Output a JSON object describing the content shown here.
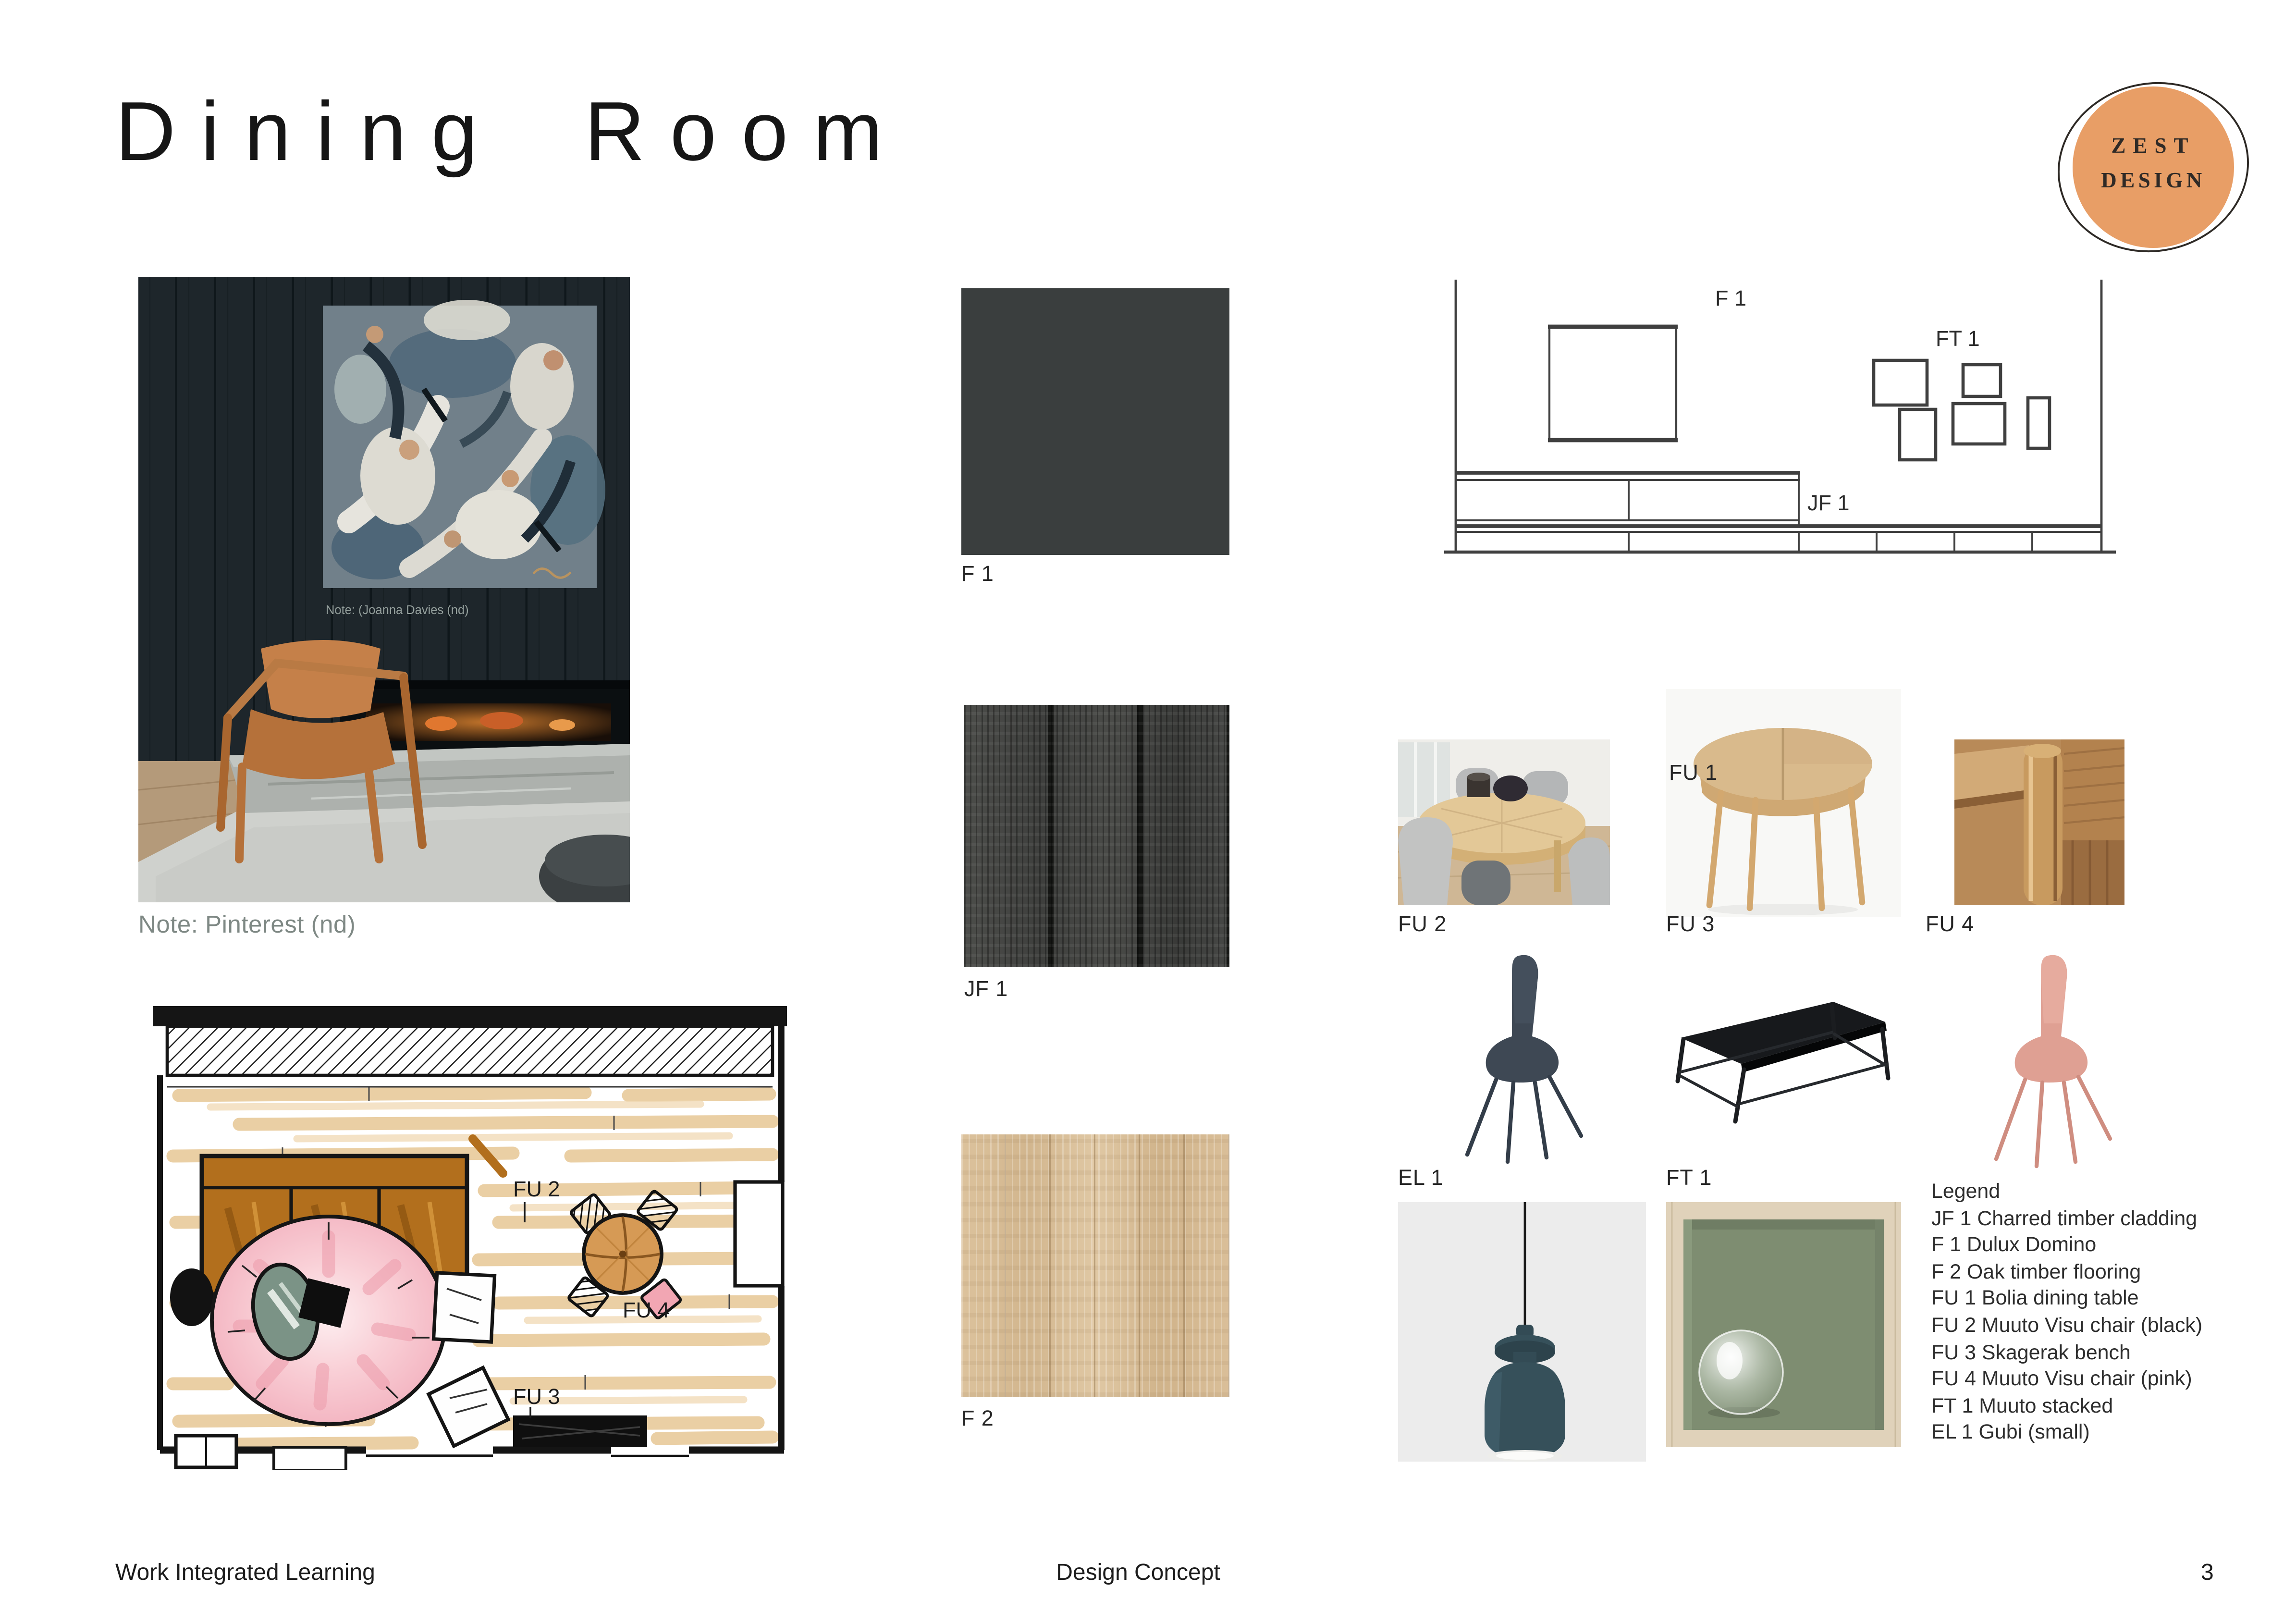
{
  "page": {
    "title": "Dining Room",
    "footer_left": "Work Integrated Learning",
    "footer_center": "Design Concept",
    "page_number": "3"
  },
  "logo": {
    "line1": "ZEST",
    "line2": "DESIGN",
    "blob_color": "#e89e66",
    "text_color": "#2f2a26"
  },
  "left_column": {
    "photo_caption_inner": "Note: (Joanna Davies (nd)",
    "photo_caption": "Note: Pinterest (nd)"
  },
  "materials": {
    "f1": {
      "label": "F 1",
      "color": "#3a3e3e"
    },
    "jf1": {
      "label": "JF 1",
      "base_color": "#454643"
    },
    "f2": {
      "label": "F 2",
      "base_color": "#d7bd96"
    }
  },
  "elevation": {
    "label_f1": "F 1",
    "label_ft1": "FT 1",
    "label_jf1": "JF 1"
  },
  "floor_plan": {
    "label_fu2": "FU 2",
    "label_fu3": "FU 3",
    "label_fu4": "FU 4"
  },
  "furniture": {
    "fu1_label": "FU 1",
    "fu2_label": "FU 2",
    "fu3_label": "FU 3",
    "fu4_label": "FU 4",
    "el1_label": "EL 1",
    "ft1_label": "FT 1"
  },
  "legend": {
    "lines": [
      "Legend",
      "JF 1 Charred timber cladding",
      "F 1 Dulux Domino",
      "F 2 Oak timber flooring",
      "FU 1 Bolia dining table",
      "FU 2 Muuto Visu chair (black)",
      "FU 3 Skagerak bench",
      "FU 4 Muuto Visu chair (pink)",
      "FT 1 Muuto stacked",
      "EL 1 Gubi (small)"
    ]
  },
  "colors": {
    "accent_orange": "#e89e66",
    "charcoal_paint": "#3a3e3e",
    "oak": "#d7bd96",
    "navy_chair": "#3e4854",
    "pink_chair": "#dfa093",
    "bench_black": "#17191c",
    "pendant_teal": "#36505a",
    "box_green": "#7e8d71",
    "box_ash": "#e0d2ba",
    "plan_pink_rug": "#f2aebc",
    "plan_sofa_brown": "#b26f1d",
    "plan_table_orange": "#d69a55",
    "plan_green_table": "#7b9386"
  }
}
